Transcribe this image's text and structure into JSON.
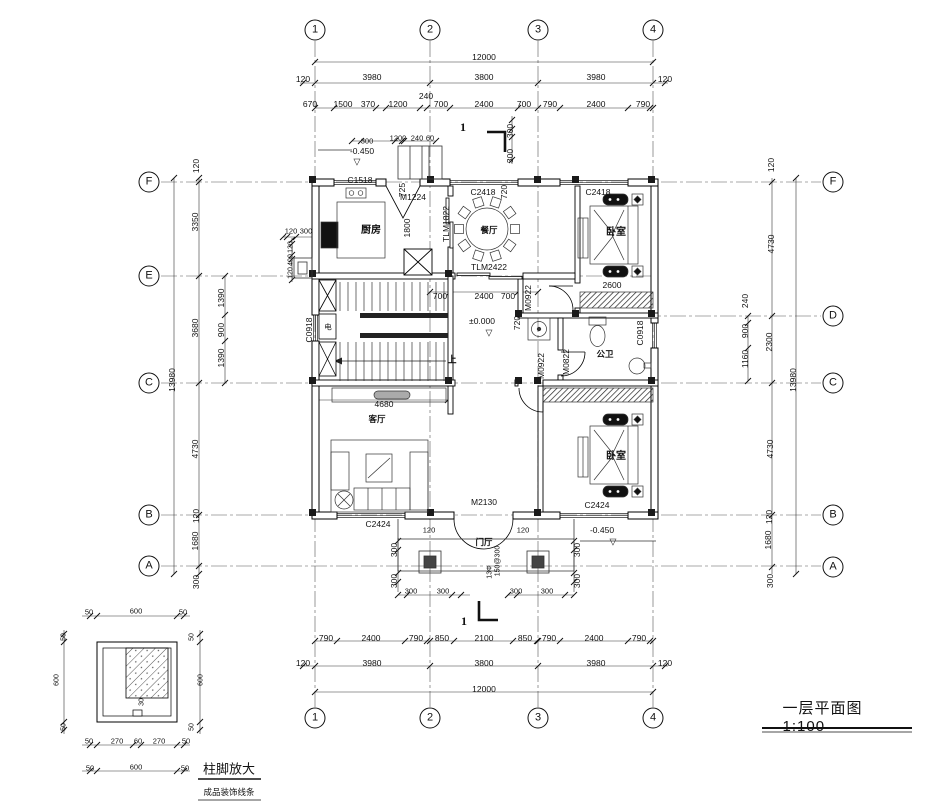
{
  "title_block": {
    "text": "一层平面图 1:100"
  },
  "detail_block": {
    "title": "柱脚放大",
    "subtitle": "成品装饰线条"
  },
  "grid": {
    "top": [
      "1",
      "2",
      "3",
      "4"
    ],
    "bottom": [
      "1",
      "2",
      "3",
      "4"
    ],
    "left": [
      "F",
      "E",
      "C",
      "B",
      "A"
    ],
    "right": [
      "F",
      "D",
      "C",
      "B",
      "A"
    ]
  },
  "rooms": [
    "厨房",
    "餐厅",
    "卧室",
    "公卫",
    "客厅",
    "门厅",
    "卧室"
  ],
  "openings": {
    "windows": [
      "C1518",
      "C2418",
      "C2424",
      "C0918"
    ],
    "doors": [
      "M1224",
      "M2130",
      "M0922",
      "M0822"
    ],
    "sliding_doors": [
      "TLM1822",
      "TLM2422"
    ]
  },
  "levels": [
    "±0.000",
    "-0.450"
  ],
  "scale": "1:100",
  "annotations": [
    {
      "t": "1",
      "x": 315,
      "y": 30,
      "c": "bubble",
      "n": "grid-bubble-1-top"
    },
    {
      "t": "2",
      "x": 430,
      "y": 30,
      "c": "bubble",
      "n": "grid-bubble-2-top"
    },
    {
      "t": "3",
      "x": 538,
      "y": 30,
      "c": "bubble",
      "n": "grid-bubble-3-top"
    },
    {
      "t": "4",
      "x": 653,
      "y": 30,
      "c": "bubble",
      "n": "grid-bubble-4-top"
    },
    {
      "t": "1",
      "x": 315,
      "y": 718,
      "c": "bubble",
      "n": "grid-bubble-1-bottom"
    },
    {
      "t": "2",
      "x": 430,
      "y": 718,
      "c": "bubble",
      "n": "grid-bubble-2-bottom"
    },
    {
      "t": "3",
      "x": 538,
      "y": 718,
      "c": "bubble",
      "n": "grid-bubble-3-bottom"
    },
    {
      "t": "4",
      "x": 653,
      "y": 718,
      "c": "bubble",
      "n": "grid-bubble-4-bottom"
    },
    {
      "t": "F",
      "x": 149,
      "y": 182,
      "c": "bubble",
      "n": "grid-bubble-F-left"
    },
    {
      "t": "E",
      "x": 149,
      "y": 276,
      "c": "bubble",
      "n": "grid-bubble-E-left"
    },
    {
      "t": "C",
      "x": 149,
      "y": 383,
      "c": "bubble",
      "n": "grid-bubble-C-left"
    },
    {
      "t": "B",
      "x": 149,
      "y": 515,
      "c": "bubble",
      "n": "grid-bubble-B-left"
    },
    {
      "t": "A",
      "x": 149,
      "y": 566,
      "c": "bubble",
      "n": "grid-bubble-A-left"
    },
    {
      "t": "F",
      "x": 833,
      "y": 182,
      "c": "bubble",
      "n": "grid-bubble-F-right"
    },
    {
      "t": "D",
      "x": 833,
      "y": 316,
      "c": "bubble",
      "n": "grid-bubble-D-right"
    },
    {
      "t": "C",
      "x": 833,
      "y": 383,
      "c": "bubble",
      "n": "grid-bubble-C-right"
    },
    {
      "t": "B",
      "x": 833,
      "y": 515,
      "c": "bubble",
      "n": "grid-bubble-B-right"
    },
    {
      "t": "A",
      "x": 833,
      "y": 567,
      "c": "bubble",
      "n": "grid-bubble-A-right"
    },
    {
      "t": "12000",
      "x": 484,
      "y": 57,
      "c": "dim"
    },
    {
      "t": "120",
      "x": 303,
      "y": 79,
      "c": "dim"
    },
    {
      "t": "3980",
      "x": 372,
      "y": 77,
      "c": "dim"
    },
    {
      "t": "3800",
      "x": 484,
      "y": 77,
      "c": "dim"
    },
    {
      "t": "3980",
      "x": 596,
      "y": 77,
      "c": "dim"
    },
    {
      "t": "120",
      "x": 665,
      "y": 79,
      "c": "dim"
    },
    {
      "t": "670",
      "x": 310,
      "y": 104,
      "c": "dim"
    },
    {
      "t": "1500",
      "x": 343,
      "y": 104,
      "c": "dim"
    },
    {
      "t": "370",
      "x": 368,
      "y": 104,
      "c": "dim"
    },
    {
      "t": "1200",
      "x": 398,
      "y": 104,
      "c": "dim"
    },
    {
      "t": "240",
      "x": 426,
      "y": 96,
      "c": "dim"
    },
    {
      "t": "700",
      "x": 441,
      "y": 104,
      "c": "dim"
    },
    {
      "t": "2400",
      "x": 484,
      "y": 104,
      "c": "dim"
    },
    {
      "t": "700",
      "x": 524,
      "y": 104,
      "c": "dim"
    },
    {
      "t": "790",
      "x": 550,
      "y": 104,
      "c": "dim"
    },
    {
      "t": "2400",
      "x": 596,
      "y": 104,
      "c": "dim"
    },
    {
      "t": "790",
      "x": 643,
      "y": 104,
      "c": "dim"
    },
    {
      "t": "300",
      "x": 367,
      "y": 141,
      "c": "tiny"
    },
    {
      "t": "1200",
      "x": 398,
      "y": 138,
      "c": "tiny"
    },
    {
      "t": "240",
      "x": 417,
      "y": 138,
      "c": "tiny"
    },
    {
      "t": "60",
      "x": 430,
      "y": 138,
      "c": "tiny"
    },
    {
      "t": "300",
      "x": 510,
      "y": 131,
      "c": "dimv"
    },
    {
      "t": "300",
      "x": 510,
      "y": 156,
      "c": "dimv"
    },
    {
      "t": "-0.450",
      "x": 362,
      "y": 151,
      "c": "lvl",
      "n": "level-mark-top"
    },
    {
      "t": "▽",
      "x": 357,
      "y": 162,
      "c": "tri",
      "n": "level-triangle-top"
    },
    {
      "t": "C1518",
      "x": 360,
      "y": 180,
      "c": "code",
      "n": "window-C1518"
    },
    {
      "t": "M1224",
      "x": 413,
      "y": 197,
      "c": "code",
      "n": "door-M1224"
    },
    {
      "t": "725",
      "x": 402,
      "y": 190,
      "c": "dimv"
    },
    {
      "t": "1800",
      "x": 407,
      "y": 228,
      "c": "dimv"
    },
    {
      "t": "TLM1822",
      "x": 446,
      "y": 224,
      "c": "codev",
      "n": "sliding-door-TLM1822"
    },
    {
      "t": "720",
      "x": 504,
      "y": 192,
      "c": "dimv"
    },
    {
      "t": "C2418",
      "x": 483,
      "y": 192,
      "c": "code",
      "n": "window-C2418-dining"
    },
    {
      "t": "C2418",
      "x": 598,
      "y": 192,
      "c": "code",
      "n": "window-C2418-bedroom"
    },
    {
      "t": "厨房",
      "x": 371,
      "y": 231,
      "c": "room",
      "n": "room-label-kitchen"
    },
    {
      "t": "餐厅",
      "x": 489,
      "y": 230,
      "c": "rooms",
      "n": "room-label-dining"
    },
    {
      "t": "卧室",
      "x": 616,
      "y": 233,
      "c": "room",
      "n": "room-label-bedroom-top"
    },
    {
      "t": "TLM2422",
      "x": 489,
      "y": 267,
      "c": "code",
      "n": "sliding-door-TLM2422"
    },
    {
      "t": "2600",
      "x": 612,
      "y": 285,
      "c": "dim"
    },
    {
      "t": "120",
      "x": 291,
      "y": 231,
      "c": "tiny"
    },
    {
      "t": "300",
      "x": 306,
      "y": 231,
      "c": "tiny"
    },
    {
      "t": "120",
      "x": 291,
      "y": 247,
      "c": "tinyv"
    },
    {
      "t": "400",
      "x": 291,
      "y": 260,
      "c": "tinyv"
    },
    {
      "t": "120",
      "x": 291,
      "y": 273,
      "c": "tinyv"
    },
    {
      "t": "120",
      "x": 196,
      "y": 166,
      "c": "dimv"
    },
    {
      "t": "3350",
      "x": 195,
      "y": 222,
      "c": "dimv"
    },
    {
      "t": "3680",
      "x": 195,
      "y": 328,
      "c": "dimv"
    },
    {
      "t": "13980",
      "x": 172,
      "y": 380,
      "c": "dimv"
    },
    {
      "t": "1390",
      "x": 221,
      "y": 298,
      "c": "dimv"
    },
    {
      "t": "900",
      "x": 221,
      "y": 330,
      "c": "dimv"
    },
    {
      "t": "1390",
      "x": 221,
      "y": 358,
      "c": "dimv"
    },
    {
      "t": "4730",
      "x": 195,
      "y": 449,
      "c": "dimv"
    },
    {
      "t": "120",
      "x": 196,
      "y": 516,
      "c": "dimv"
    },
    {
      "t": "1680",
      "x": 195,
      "y": 541,
      "c": "dimv"
    },
    {
      "t": "300",
      "x": 196,
      "y": 582,
      "c": "dimv"
    },
    {
      "t": "C0918",
      "x": 309,
      "y": 330,
      "c": "codev",
      "n": "window-C0918-left"
    },
    {
      "t": "电",
      "x": 328,
      "y": 327,
      "c": "tiny",
      "n": "electric-panel-label"
    },
    {
      "t": "700",
      "x": 440,
      "y": 296,
      "c": "dim"
    },
    {
      "t": "2400",
      "x": 484,
      "y": 296,
      "c": "dim"
    },
    {
      "t": "700",
      "x": 508,
      "y": 296,
      "c": "dim"
    },
    {
      "t": "M0922",
      "x": 528,
      "y": 298,
      "c": "codev",
      "n": "door-M0922-bedroom-top"
    },
    {
      "t": "±0.000",
      "x": 482,
      "y": 321,
      "c": "lvl",
      "n": "level-mark-zero"
    },
    {
      "t": "▽",
      "x": 489,
      "y": 333,
      "c": "tri",
      "n": "level-triangle-zero"
    },
    {
      "t": "720",
      "x": 517,
      "y": 323,
      "c": "dimv"
    },
    {
      "t": "上",
      "x": 452,
      "y": 360,
      "c": "small",
      "n": "stair-up-label"
    },
    {
      "t": "M0822",
      "x": 566,
      "y": 362,
      "c": "codev",
      "n": "door-M0822-bath"
    },
    {
      "t": "M0922",
      "x": 541,
      "y": 366,
      "c": "codev",
      "n": "door-M0922-bedroom-bottom"
    },
    {
      "t": "公卫",
      "x": 605,
      "y": 354,
      "c": "rooms",
      "n": "room-label-bathroom"
    },
    {
      "t": "C0918",
      "x": 640,
      "y": 333,
      "c": "codev",
      "n": "window-C0918-right"
    },
    {
      "t": "4680",
      "x": 384,
      "y": 404,
      "c": "dim"
    },
    {
      "t": "客厅",
      "x": 377,
      "y": 419,
      "c": "rooms",
      "n": "room-label-living"
    },
    {
      "t": "卧室",
      "x": 616,
      "y": 457,
      "c": "room",
      "n": "room-label-bedroom-bottom"
    },
    {
      "t": "C2424",
      "x": 378,
      "y": 524,
      "c": "code",
      "n": "window-C2424-living"
    },
    {
      "t": "120",
      "x": 429,
      "y": 530,
      "c": "tiny"
    },
    {
      "t": "M2130",
      "x": 484,
      "y": 502,
      "c": "code",
      "n": "door-M2130-entry"
    },
    {
      "t": "门厅",
      "x": 484,
      "y": 542,
      "c": "rooms",
      "n": "room-label-foyer"
    },
    {
      "t": "13Φ",
      "x": 490,
      "y": 572,
      "c": "tinyv"
    },
    {
      "t": "150@300",
      "x": 498,
      "y": 561,
      "c": "tinyv"
    },
    {
      "t": "120",
      "x": 523,
      "y": 530,
      "c": "tiny"
    },
    {
      "t": "-0.450",
      "x": 602,
      "y": 530,
      "c": "lvl",
      "n": "level-mark-bottom"
    },
    {
      "t": "▽",
      "x": 613,
      "y": 542,
      "c": "tri",
      "n": "level-triangle-bottom"
    },
    {
      "t": "C2424",
      "x": 597,
      "y": 505,
      "c": "code",
      "n": "window-C2424-bedroom"
    },
    {
      "t": "300",
      "x": 394,
      "y": 550,
      "c": "dimv"
    },
    {
      "t": "300",
      "x": 394,
      "y": 581,
      "c": "dimv"
    },
    {
      "t": "300",
      "x": 411,
      "y": 591,
      "c": "tiny"
    },
    {
      "t": "300",
      "x": 443,
      "y": 591,
      "c": "tiny"
    },
    {
      "t": "300",
      "x": 516,
      "y": 591,
      "c": "tiny"
    },
    {
      "t": "300",
      "x": 547,
      "y": 591,
      "c": "tiny"
    },
    {
      "t": "300",
      "x": 577,
      "y": 550,
      "c": "dimv"
    },
    {
      "t": "300",
      "x": 577,
      "y": 581,
      "c": "dimv"
    },
    {
      "t": "790",
      "x": 326,
      "y": 638,
      "c": "dim"
    },
    {
      "t": "2400",
      "x": 371,
      "y": 638,
      "c": "dim"
    },
    {
      "t": "790",
      "x": 416,
      "y": 638,
      "c": "dim"
    },
    {
      "t": "850",
      "x": 442,
      "y": 638,
      "c": "dim"
    },
    {
      "t": "2100",
      "x": 484,
      "y": 638,
      "c": "dim"
    },
    {
      "t": "850",
      "x": 525,
      "y": 638,
      "c": "dim"
    },
    {
      "t": "790",
      "x": 549,
      "y": 638,
      "c": "dim"
    },
    {
      "t": "2400",
      "x": 594,
      "y": 638,
      "c": "dim"
    },
    {
      "t": "790",
      "x": 639,
      "y": 638,
      "c": "dim"
    },
    {
      "t": "120",
      "x": 303,
      "y": 663,
      "c": "dim"
    },
    {
      "t": "3980",
      "x": 372,
      "y": 663,
      "c": "dim"
    },
    {
      "t": "3800",
      "x": 484,
      "y": 663,
      "c": "dim"
    },
    {
      "t": "3980",
      "x": 596,
      "y": 663,
      "c": "dim"
    },
    {
      "t": "120",
      "x": 665,
      "y": 663,
      "c": "dim"
    },
    {
      "t": "12000",
      "x": 484,
      "y": 689,
      "c": "dim"
    },
    {
      "t": "1",
      "x": 464,
      "y": 621,
      "c": "sec",
      "n": "section-mark-1-bottom"
    },
    {
      "t": "1",
      "x": 463,
      "y": 127,
      "c": "sec",
      "n": "section-mark-1-top"
    },
    {
      "t": "120",
      "x": 771,
      "y": 165,
      "c": "dimv"
    },
    {
      "t": "4730",
      "x": 771,
      "y": 244,
      "c": "dimv"
    },
    {
      "t": "240",
      "x": 745,
      "y": 301,
      "c": "dimv"
    },
    {
      "t": "900",
      "x": 745,
      "y": 331,
      "c": "dimv"
    },
    {
      "t": "1160",
      "x": 745,
      "y": 359,
      "c": "dimv"
    },
    {
      "t": "2300",
      "x": 769,
      "y": 342,
      "c": "dimv"
    },
    {
      "t": "13980",
      "x": 793,
      "y": 380,
      "c": "dimv"
    },
    {
      "t": "4730",
      "x": 770,
      "y": 449,
      "c": "dimv"
    },
    {
      "t": "120",
      "x": 769,
      "y": 517,
      "c": "dimv"
    },
    {
      "t": "1680",
      "x": 768,
      "y": 540,
      "c": "dimv"
    },
    {
      "t": "300",
      "x": 770,
      "y": 581,
      "c": "dimv"
    },
    {
      "t": "50",
      "x": 89,
      "y": 612,
      "c": "tiny"
    },
    {
      "t": "600",
      "x": 136,
      "y": 611,
      "c": "tiny"
    },
    {
      "t": "50",
      "x": 183,
      "y": 612,
      "c": "tiny"
    },
    {
      "t": "50",
      "x": 64,
      "y": 637,
      "c": "tinyv"
    },
    {
      "t": "600",
      "x": 57,
      "y": 680,
      "c": "tinyv"
    },
    {
      "t": "50",
      "x": 64,
      "y": 727,
      "c": "tinyv"
    },
    {
      "t": "50",
      "x": 192,
      "y": 637,
      "c": "tinyv"
    },
    {
      "t": "600",
      "x": 201,
      "y": 680,
      "c": "tinyv"
    },
    {
      "t": "50",
      "x": 192,
      "y": 727,
      "c": "tinyv"
    },
    {
      "t": "50",
      "x": 89,
      "y": 741,
      "c": "tiny"
    },
    {
      "t": "270",
      "x": 117,
      "y": 741,
      "c": "tiny"
    },
    {
      "t": "60",
      "x": 138,
      "y": 741,
      "c": "tiny"
    },
    {
      "t": "270",
      "x": 159,
      "y": 741,
      "c": "tiny"
    },
    {
      "t": "50",
      "x": 186,
      "y": 741,
      "c": "tiny"
    },
    {
      "t": "50",
      "x": 90,
      "y": 768,
      "c": "tiny"
    },
    {
      "t": "600",
      "x": 136,
      "y": 767,
      "c": "tiny"
    },
    {
      "t": "50",
      "x": 185,
      "y": 768,
      "c": "tiny"
    },
    {
      "t": "30",
      "x": 142,
      "y": 702,
      "c": "tinyv"
    }
  ]
}
